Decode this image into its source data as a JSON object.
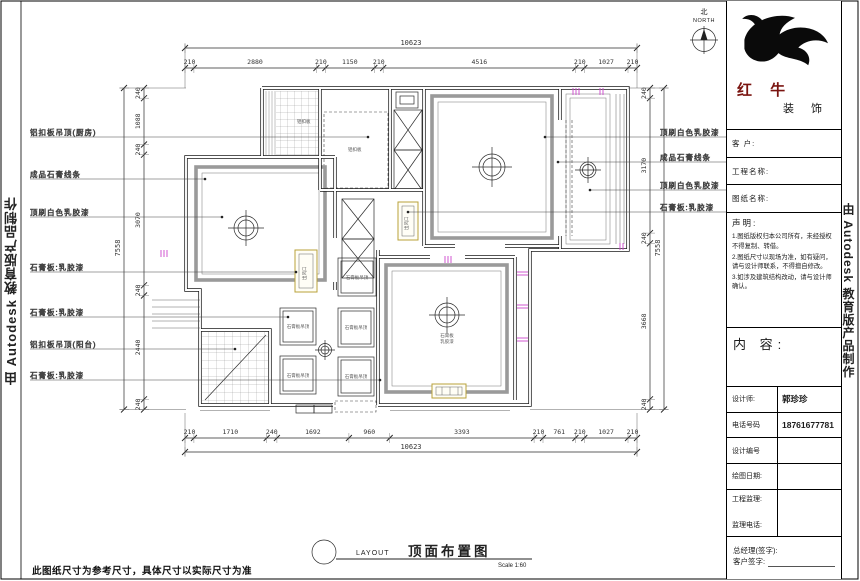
{
  "watermark": {
    "text": "由 Autodesk 教育版产品制作"
  },
  "north": {
    "top": "北",
    "label": "NORTH"
  },
  "dims": {
    "top": {
      "total": "10623",
      "segments": [
        "210",
        "2880",
        "210",
        "1150",
        "210",
        "4516",
        "210",
        "1027",
        "210"
      ]
    },
    "bottom": {
      "total": "10623",
      "segments": [
        "210",
        "1710",
        "240",
        "1692",
        "960",
        "3393",
        "210",
        "761",
        "210",
        "1027",
        "210"
      ]
    },
    "left": {
      "total": "7558",
      "segments": [
        "240",
        "1088",
        "240",
        "3070",
        "240",
        "2440",
        "240"
      ]
    },
    "right": {
      "total": "7558",
      "segments": [
        "240",
        "3170",
        "240",
        "3668",
        "240"
      ]
    }
  },
  "annotations": {
    "left": [
      "铝扣板吊顶(厨房)",
      "成品石膏线条",
      "顶刷白色乳胶漆",
      "石膏板:乳胶漆",
      "石膏板:乳胶漆",
      "铝扣板吊顶(阳台)",
      "石膏板:乳胶漆"
    ],
    "right": [
      "顶刷白色乳胶漆",
      "成品石膏线条",
      "顶刷白色乳胶漆",
      "石膏板:乳胶漆"
    ]
  },
  "plan": {
    "coffer_label": "石膏板吊顶",
    "ac_vent_label": "出风口",
    "kitchen_note": "铝扣板",
    "bath_note": "铝扣板",
    "bedroom2_note_1": "石膏板",
    "bedroom2_note_2": "乳胶漆"
  },
  "footer": {
    "layout": "LAYOUT",
    "title": "顶面布置图",
    "scale": "Scale  1:60",
    "note": "此图纸尺寸为参考尺寸，具体尺寸以实际尺寸为准"
  },
  "titleblock": {
    "brand_1": "红 牛",
    "brand_2": "装 饰",
    "client_label": "客 户:",
    "project_label": "工程名称:",
    "drawing_label": "图纸名称:",
    "statement_title": "声明:",
    "statement_items": [
      "1.图纸版权归本公司所有，未经授权不得复制、转借。",
      "2.图纸尺寸以现场为准，如有疑问，请与设计师联系，不得擅自修改。",
      "3.如涉及建筑结构改动，请与设计师确认。"
    ],
    "content_label": "内 容:",
    "fields": [
      {
        "label": "设计师:",
        "value": "郭珍珍"
      },
      {
        "label": "电话号码",
        "value": "18761677781"
      },
      {
        "label": "设计编号",
        "value": ""
      },
      {
        "label": "绘图日期:",
        "value": ""
      }
    ],
    "supervisor_label": "工程监理:",
    "supervisor_phone_label": "监理电话:",
    "manager_label": "总经理(签字):",
    "client_sign_label": "客户签字:"
  },
  "colors": {
    "accent_magenta": "#cc44cc",
    "accent_yellow": "#b8a23a",
    "brand_red": "#7a1410",
    "molding_gray": "#9a9a9a"
  }
}
